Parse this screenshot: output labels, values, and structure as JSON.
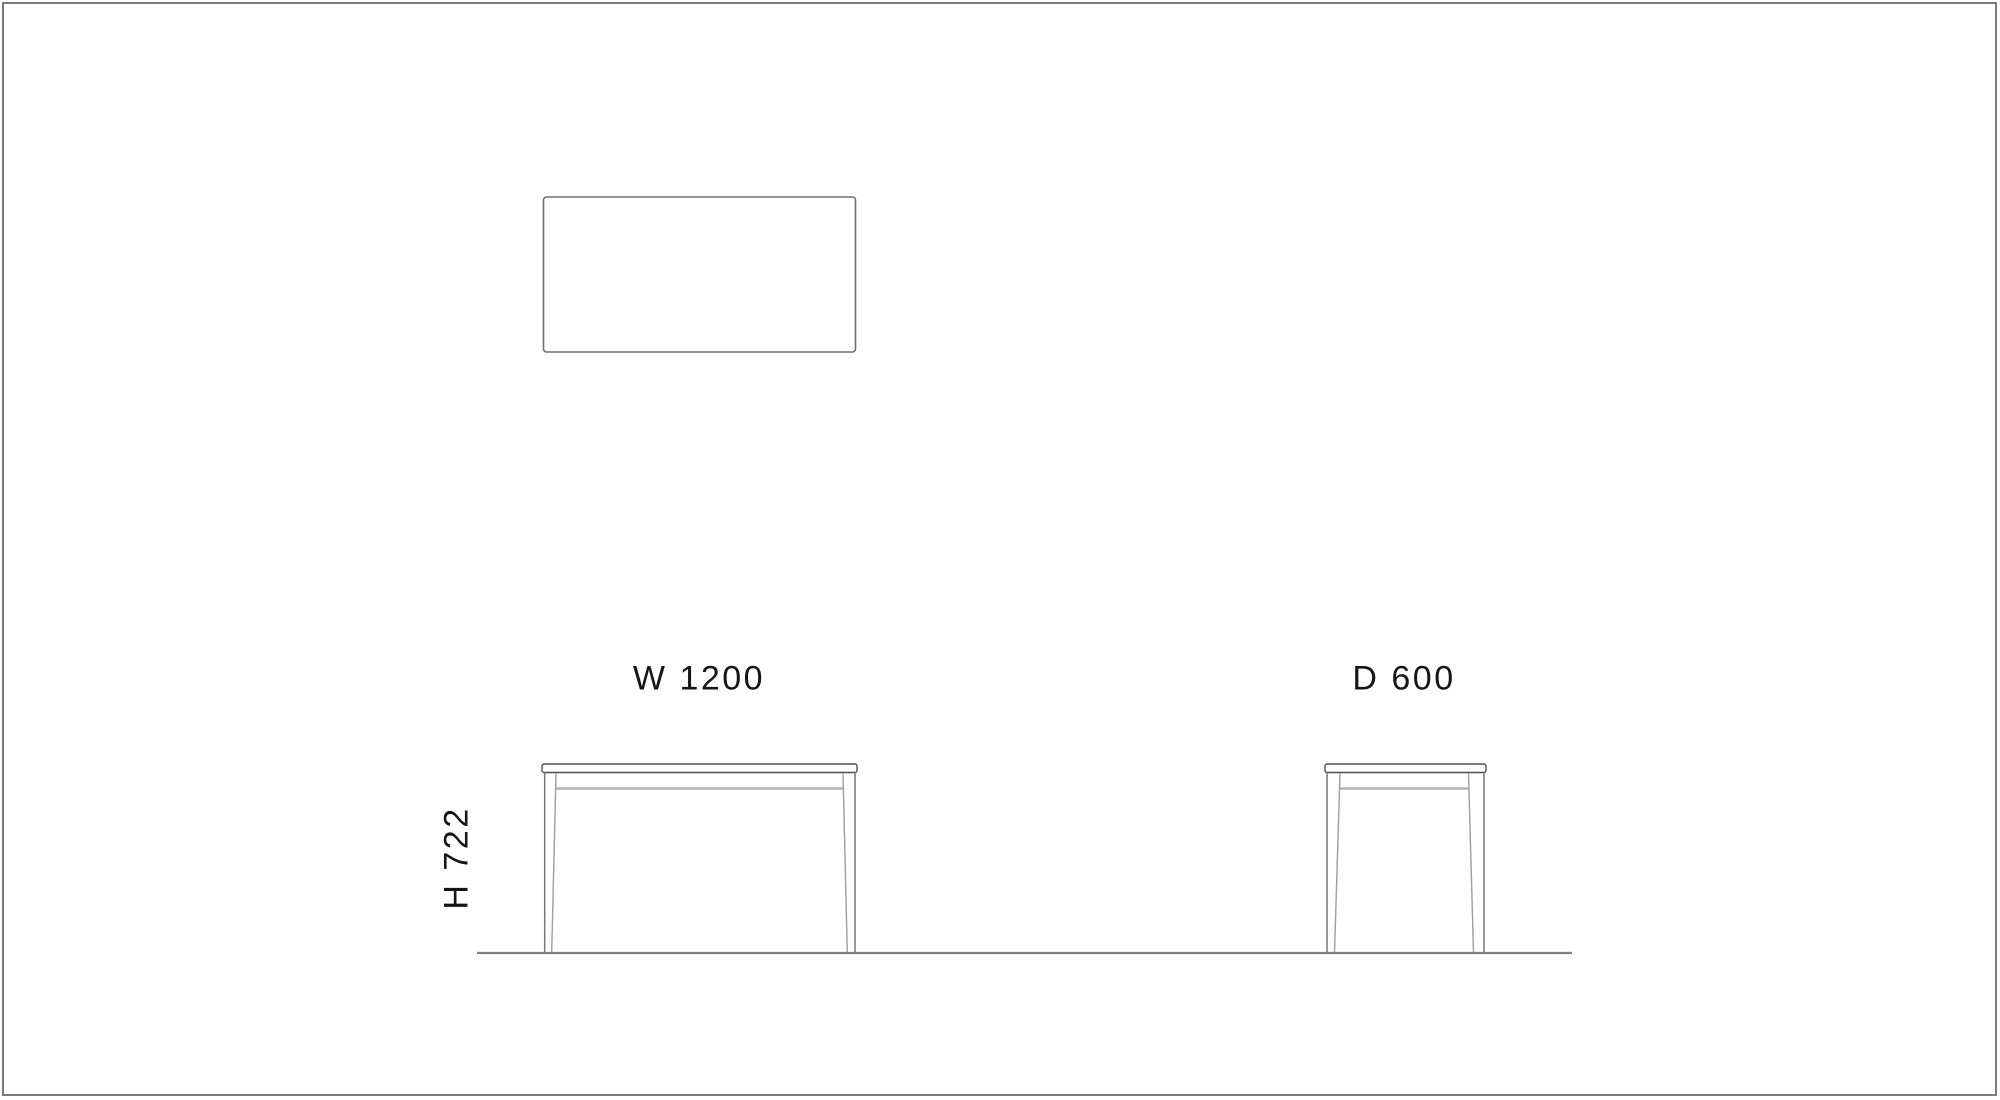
{
  "sheet": {
    "labels": {
      "width": "W 1200",
      "depth": "D 600",
      "height": "H 722"
    },
    "dimensions_mm": {
      "width": 1200,
      "depth": 600,
      "height": 722
    },
    "colors": {
      "background": "#ffffff",
      "sheet_border": "#7c7c7c",
      "outline_dark": "#4f4f4f",
      "leg_outer": "#777777",
      "leg_inner": "#9e9e9e",
      "apron_gray": "#b5b5b5",
      "ground_line": "#7f7f7f",
      "plan_outline": "#6e6e6e",
      "text": "#161616"
    }
  }
}
